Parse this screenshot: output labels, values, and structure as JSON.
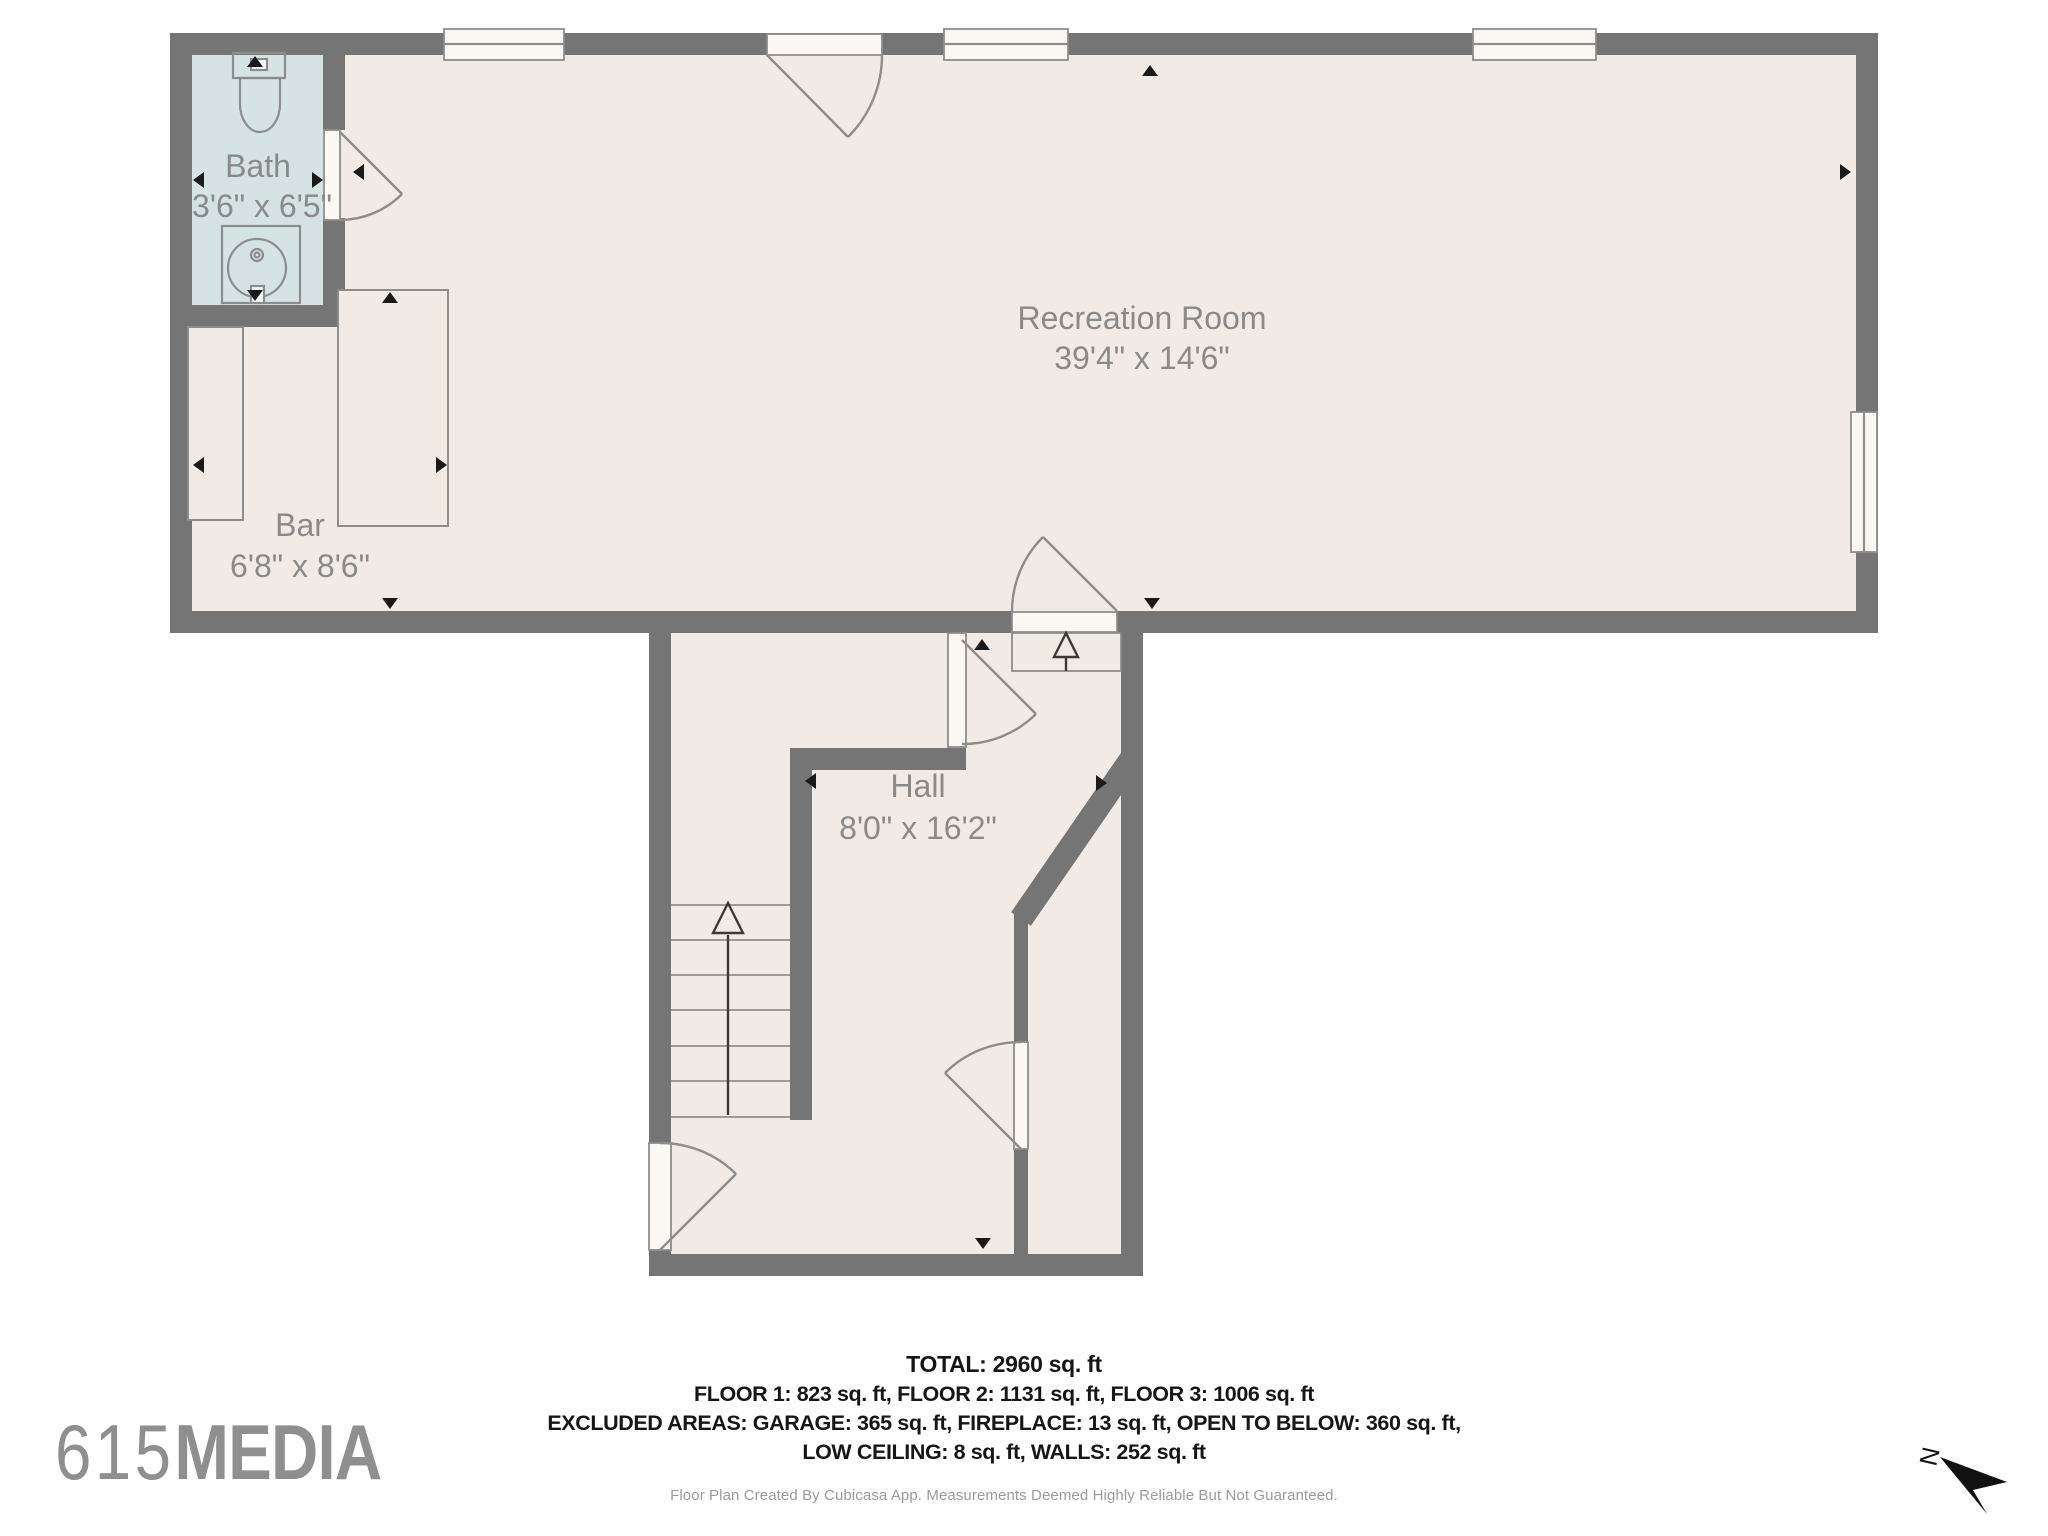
{
  "rooms": {
    "bath": {
      "name": "Bath",
      "dims": "3'6\" x 6'5\""
    },
    "recreation": {
      "name": "Recreation Room",
      "dims": "39'4\" x 14'6\""
    },
    "bar": {
      "name": "Bar",
      "dims": "6'8\" x 8'6\""
    },
    "hall": {
      "name": "Hall",
      "dims": "8'0\" x 16'2\""
    }
  },
  "summary": {
    "total": "TOTAL: 2960 sq. ft",
    "floors": "FLOOR 1: 823 sq. ft, FLOOR 2: 1131 sq. ft, FLOOR 3: 1006 sq. ft",
    "excluded_line1": "EXCLUDED AREAS: GARAGE: 365 sq. ft, FIREPLACE: 13 sq. ft, OPEN TO BELOW: 360 sq. ft,",
    "excluded_line2": "LOW CEILING: 8 sq. ft, WALLS: 252 sq. ft",
    "disclaimer": "Floor Plan Created By Cubicasa App. Measurements Deemed Highly Reliable But Not Guaranteed."
  },
  "branding": {
    "logo_number": "615",
    "logo_word": "MEDIA"
  },
  "compass": {
    "label": "N"
  },
  "colors": {
    "wall": "#757575",
    "floor": "#f2ebe5",
    "bath_floor": "#d6e3e4",
    "fixture_stroke": "#8d8d8d",
    "room_label_text": "#8a8a8a",
    "summary_text": "#161616",
    "dimension_tick": "#1a1a1a",
    "logo": "#8f8f8f"
  }
}
